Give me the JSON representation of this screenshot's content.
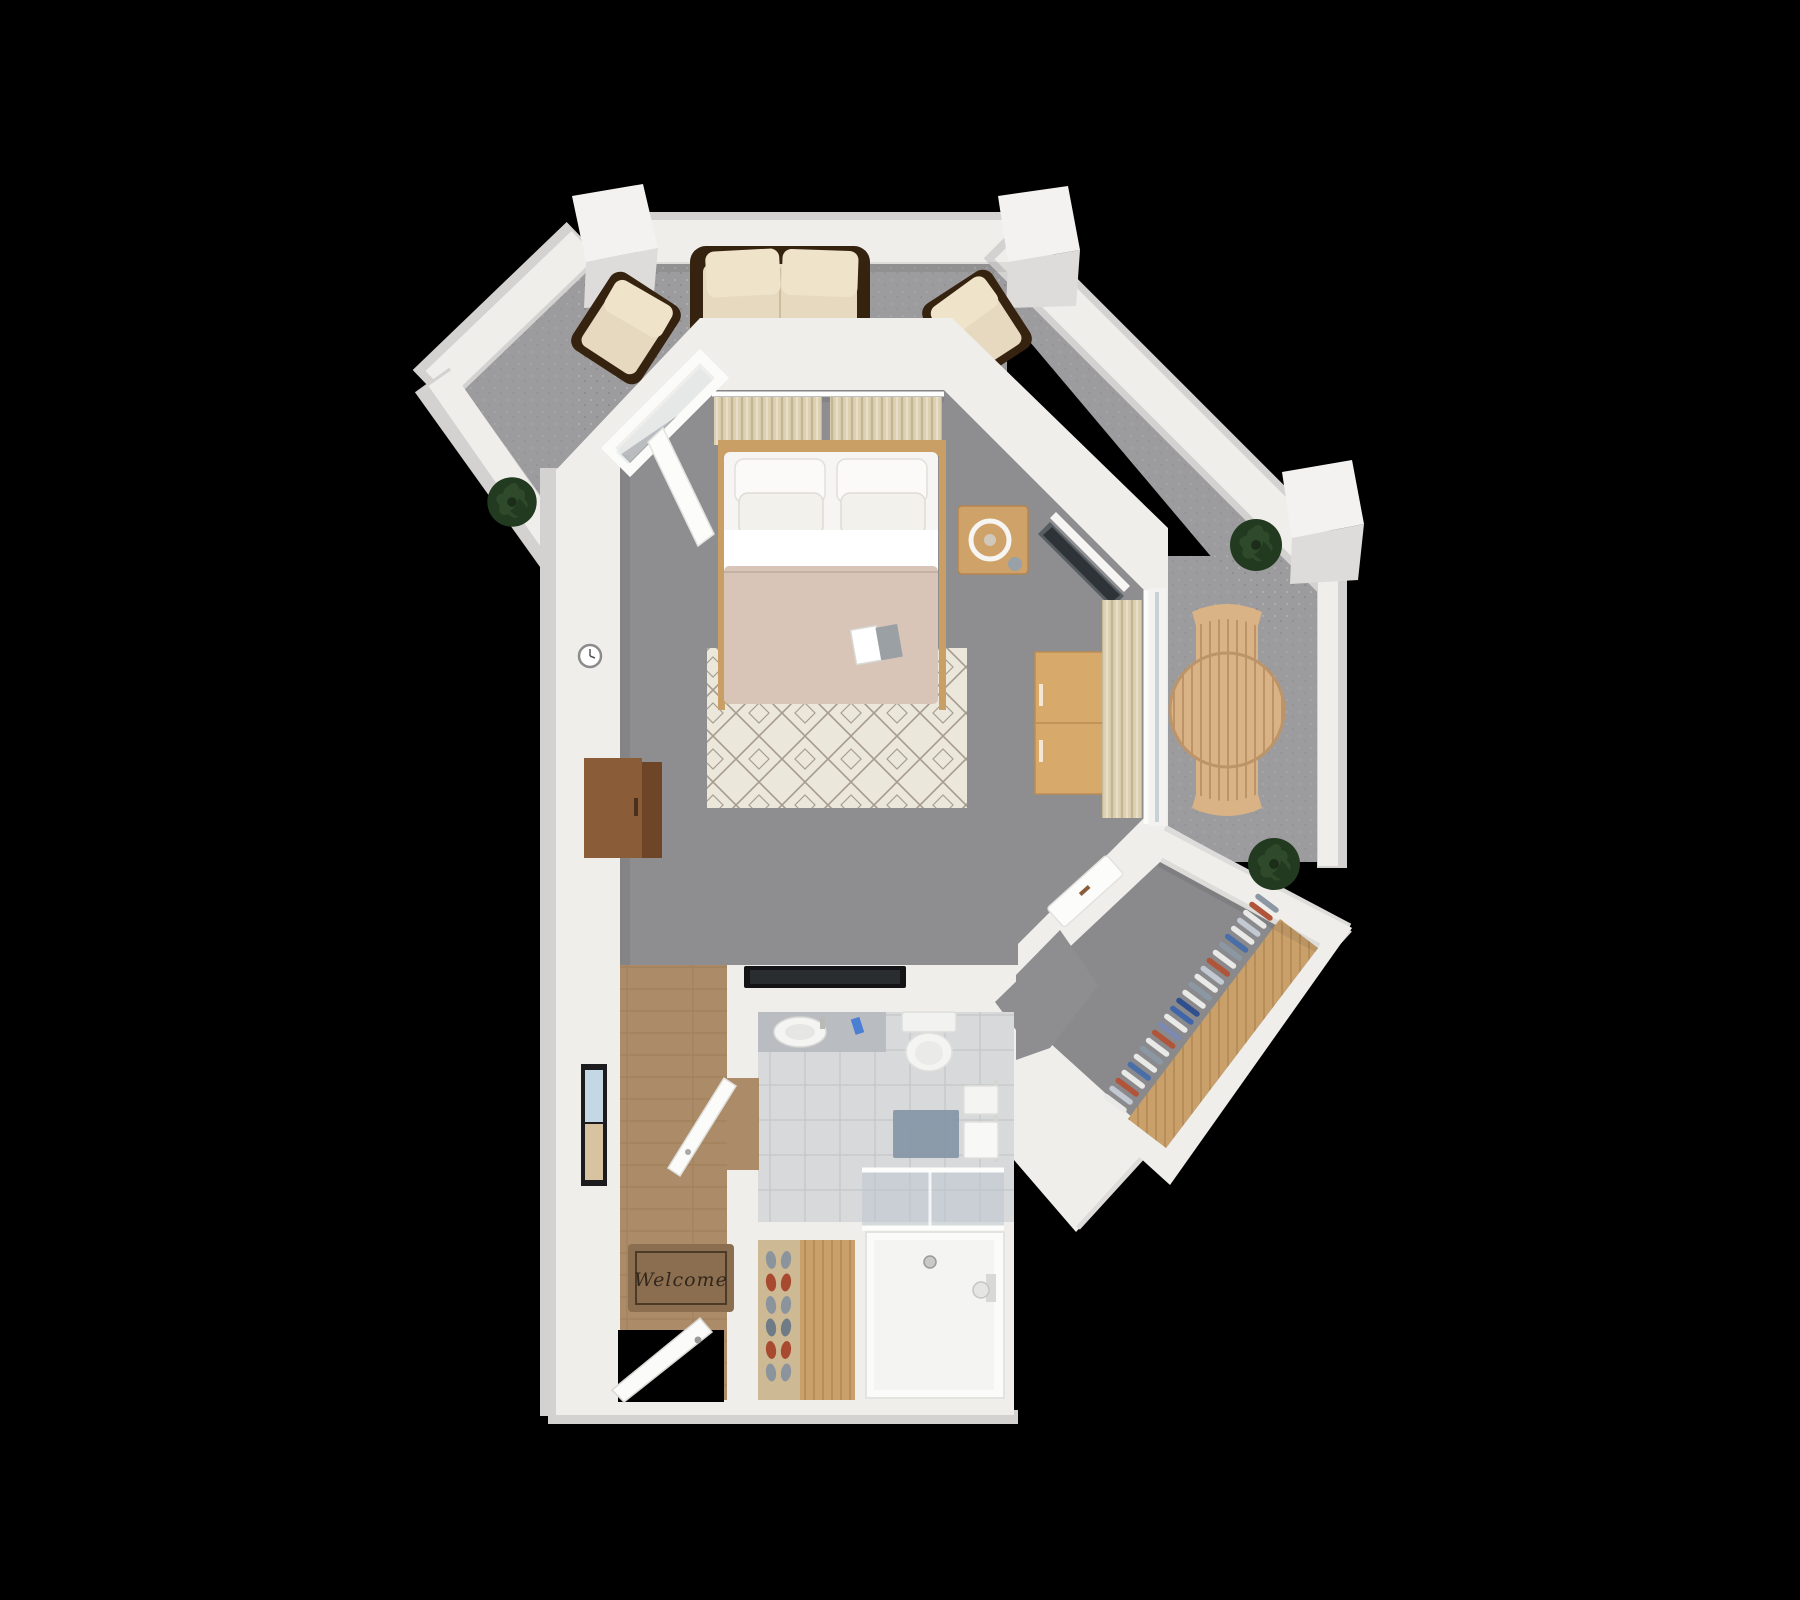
{
  "entry": {
    "welcome_mat_text": "Welcome",
    "shoe_colors": [
      "#8b949c",
      "#a84a30",
      "#8b949c",
      "#6f7b86",
      "#a84a30",
      "#8b949c"
    ]
  },
  "closet": {
    "hanger_colors": [
      "#e9e9e7",
      "#c2c9d2",
      "#b0543a",
      "#e9e9e7",
      "#4a6fa8",
      "#e9e9e7",
      "#8c97a4",
      "#e9e9e7",
      "#b0543a",
      "#7d89b0",
      "#e9e9e7",
      "#3f66a8",
      "#2f4f8f",
      "#e9e9e7",
      "#8c97a4",
      "#e9e9e7",
      "#c2c9d2",
      "#b0543a",
      "#e9e9e7",
      "#8c97a4",
      "#4a6fa8",
      "#e9e9e7",
      "#c2c9d2",
      "#e9e9e7",
      "#b0543a",
      "#8c97a4"
    ]
  },
  "colors": {
    "background": "#000000",
    "patio_floor": "#9c9c9e",
    "interior_floor": "#8e8e91",
    "closet_floor": "#8a8a8d",
    "wall": "#efeeeb",
    "wall_side": "#d3d2d0",
    "wood_floor": "#ab8b68",
    "wood_floor_line": "#96784f",
    "tile_floor": "#d8d9da",
    "tile_line": "#c7c8c9",
    "mattress": "#f6f5f3",
    "pillow": "#fbfaf8",
    "bed_sheet": "#ffffff",
    "duvet": "#d8c5b8",
    "headboard": "#c99f66",
    "nightstand": "#cfa269",
    "dresser": "#d7aa6c",
    "rug": "#ece7db",
    "rug_line": "#a69d90",
    "curtain": "#ddd1b2",
    "curtain_line": "#c3b694",
    "sofa_frame": "#35220f",
    "sofa_cushion": "#e6d9bf",
    "outdoor_wood": "#d9b285",
    "outdoor_wood_dark": "#bd9468",
    "plant": "#2f4a2b",
    "plant_dark": "#223a20",
    "tv": "#565d63",
    "tv_dark": "#2e3337",
    "glass": "#b9c6cd",
    "mat": "#8a6e4f",
    "mat_text": "#33261a",
    "shelf_wood": "#c9a06a",
    "shelf_line": "#ad8450",
    "console": "#fcfcfa",
    "door": "#fbfbf9",
    "door_edge": "#d9d8d4",
    "frame_black": "#1c1c1e",
    "art_blue": "#c3d8e4",
    "art_tan": "#d8c3a0",
    "vanity": "#b9bcc0",
    "fixture_white": "#f4f4f2",
    "bathmat": "#8496a6",
    "accent_blue": "#4a7fd4",
    "cabinet_wood": "#8a5c38",
    "cabinet_wood_dark": "#6f4527"
  }
}
